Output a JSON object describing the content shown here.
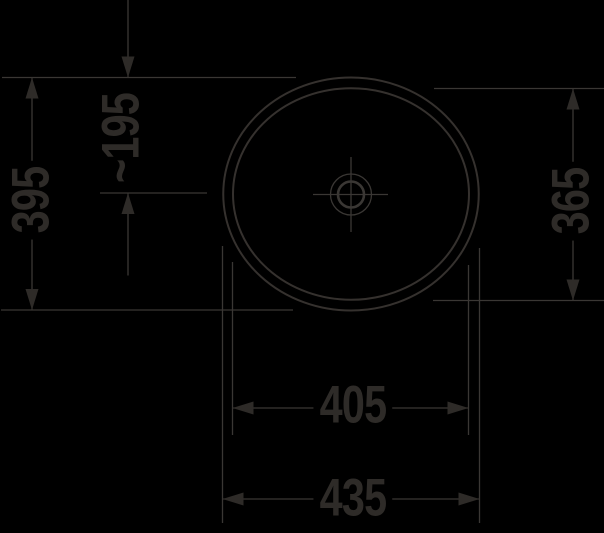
{
  "drawing": {
    "kind": "technical-dimension-drawing",
    "view": "basin-top-view"
  },
  "colors": {
    "background": "#000000",
    "ink": "#2e2b28",
    "line": "#3a3734"
  },
  "dimension_labels": {
    "overall_depth": "395",
    "drain_offset": "~195",
    "basin_depth": "365",
    "basin_width": "405",
    "overall_width": "435"
  }
}
